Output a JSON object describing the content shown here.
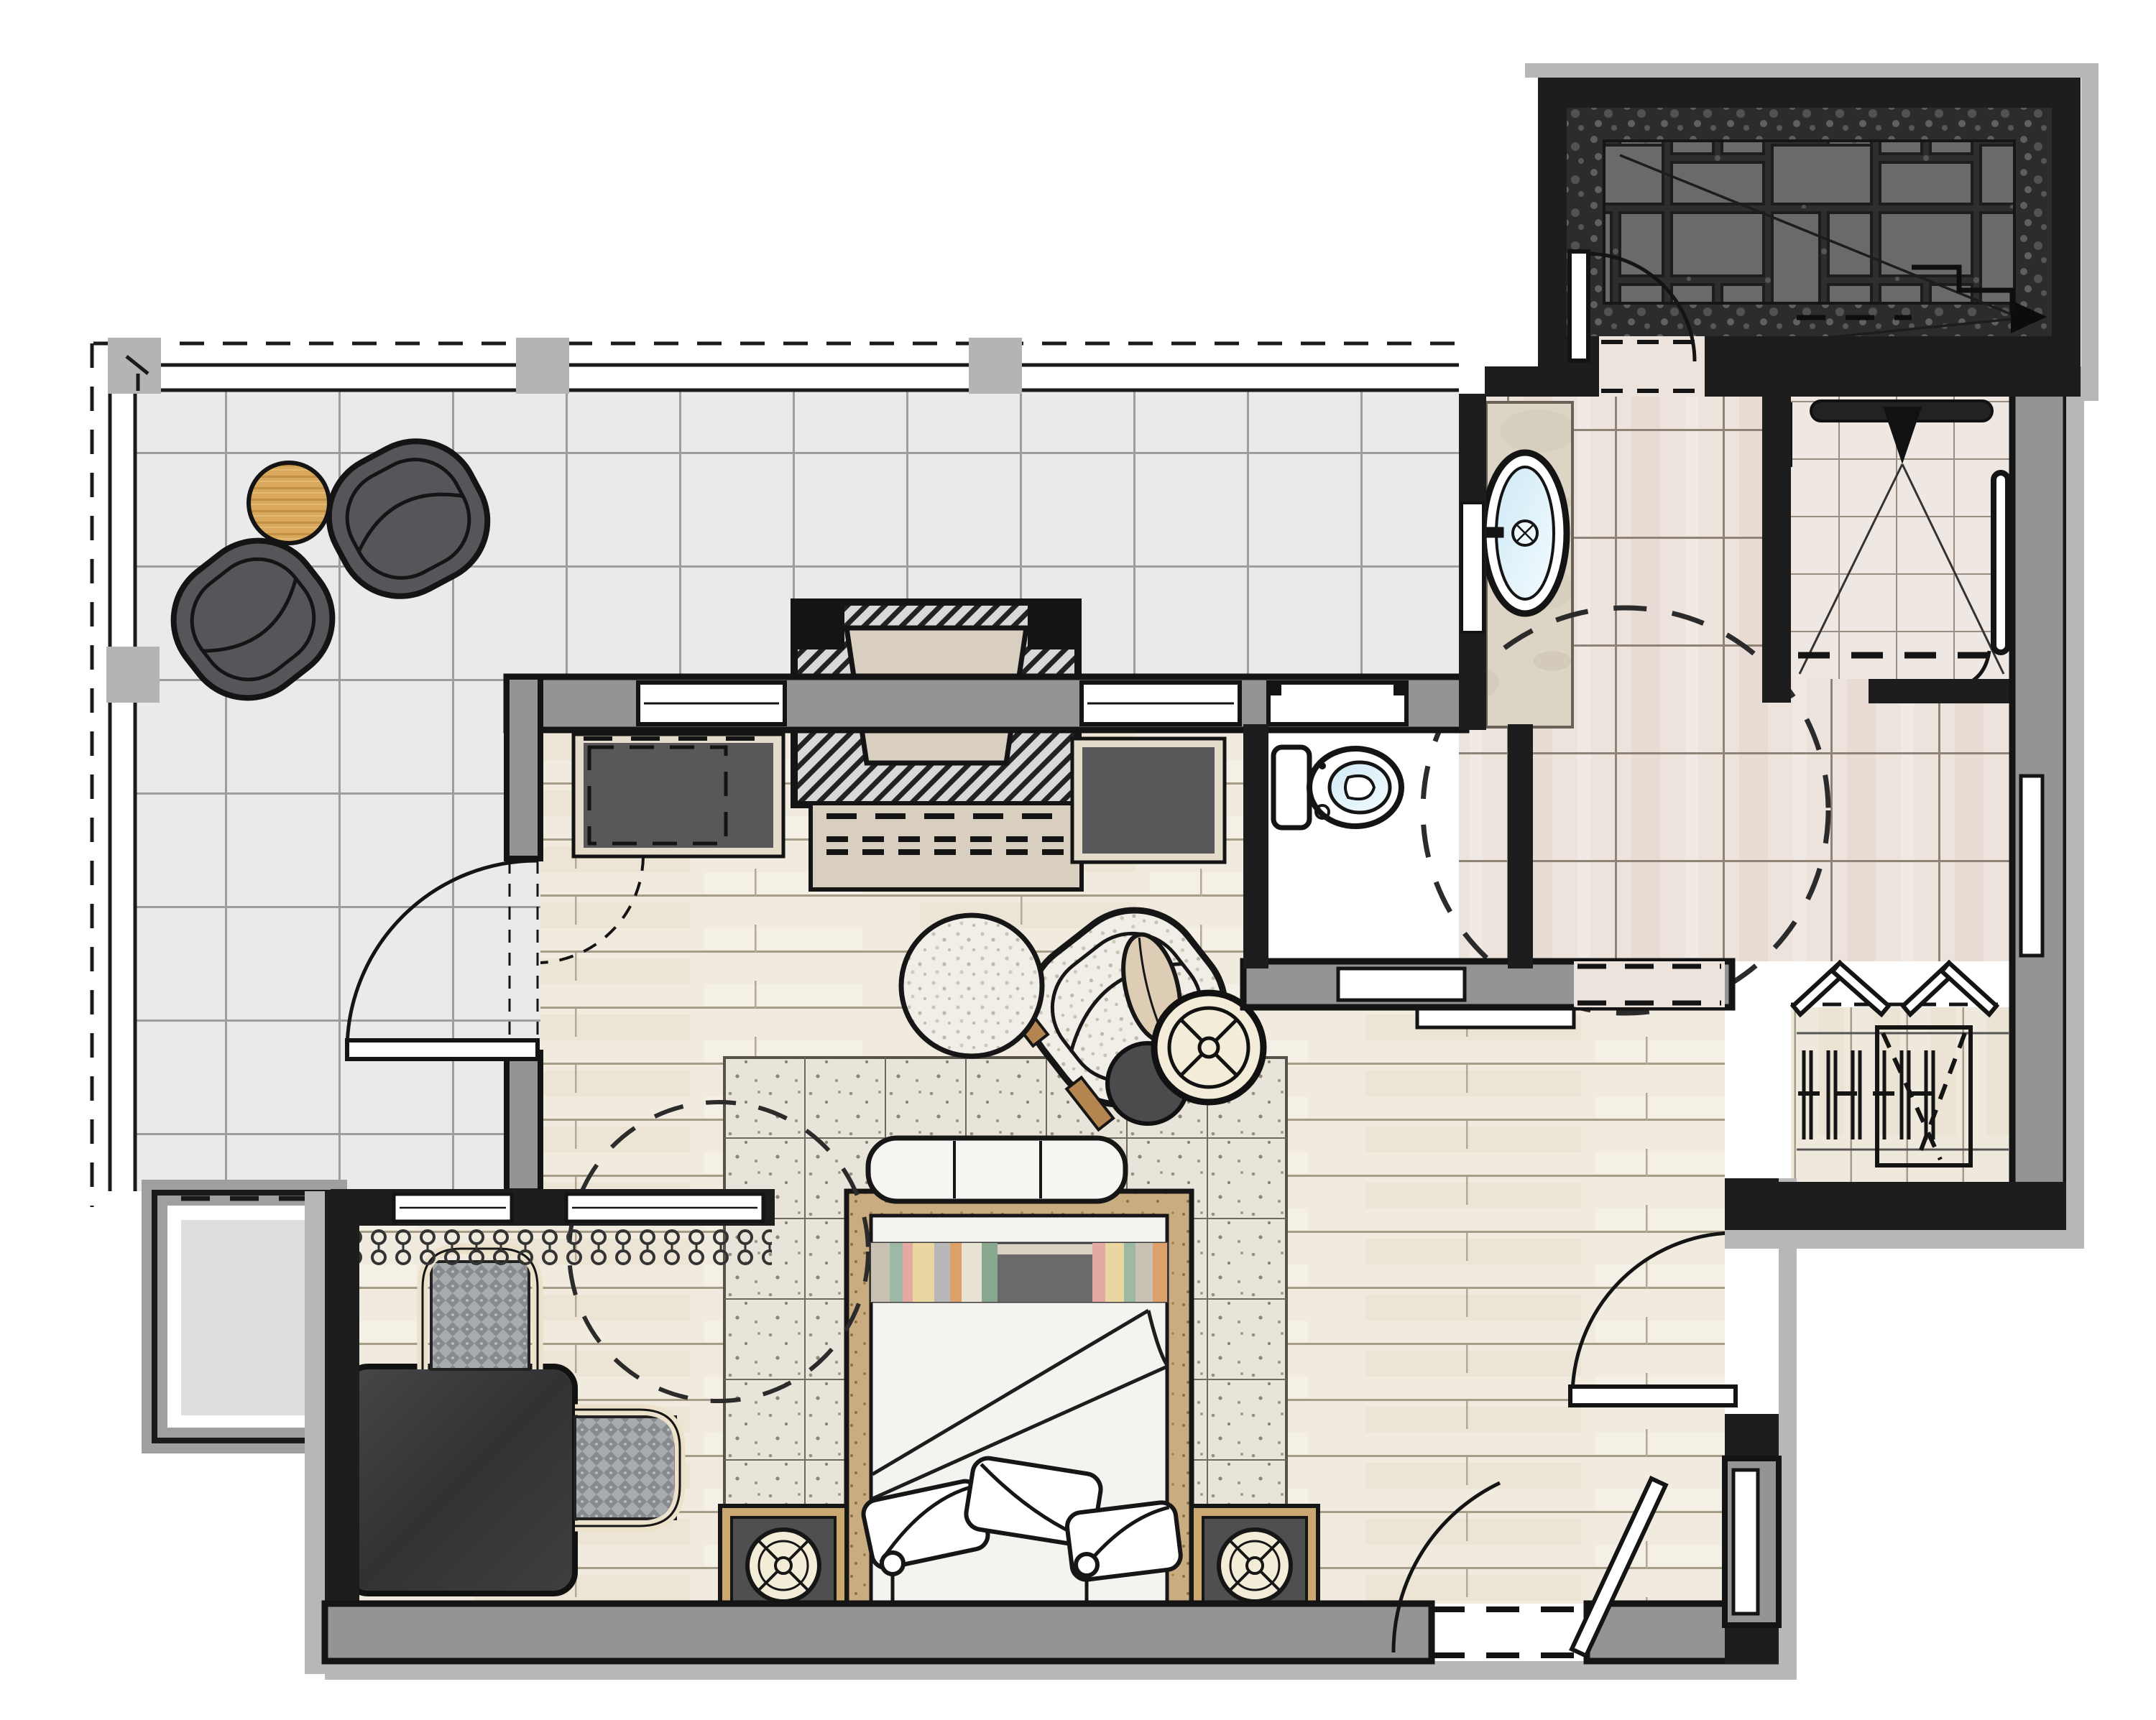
{
  "document": {
    "title": "Hotel suite interior floor plan rendering"
  },
  "colors": {
    "wall_black": "#1a1a1a",
    "wall_fill_gray": "#949494",
    "outer_gray": "#b7b7b7",
    "balcony_tile": "#eaeaec",
    "balcony_grout": "#9d9da0",
    "wood_floor": "#f1ebdf",
    "wood_line": "#a69d89",
    "bath_tile": "#ece3dc",
    "bath_grout": "#8f8276",
    "patio_dark": "#2e2e30",
    "patio_slab": "#6a6a6c",
    "marble_deck": "#dcd4c5",
    "tub_water": "#d6ecf7",
    "rug_base": "#e8e4d9",
    "bed_wood_frame": "#c9ad80",
    "round_table_wood": "#d8a95c",
    "dark_furniture": "#4b4b4d",
    "lounge_chair_gray": "#55565a",
    "boucle_cream": "#f0eee7",
    "desk_charcoal": "#39393b",
    "woven_seat_gray": "#a7abae",
    "cream_frame": "#ece2cb",
    "stripe_colors": [
      "#c9c2b4",
      "#e4a9a2",
      "#9db8a4",
      "#ead6a0",
      "#6a6a6a",
      "#dca06a",
      "#b8b8b8",
      "#88a890"
    ]
  },
  "rooms": {
    "balcony": {
      "label": "Tiled balcony terrace"
    },
    "patio": {
      "label": "Dark flagstone patio"
    },
    "bedroom": {
      "label": "Bedroom with whitewashed wood floor"
    },
    "alcove": {
      "label": "Desk alcove"
    },
    "bathroom": {
      "label": "Bathroom"
    },
    "wc": {
      "label": "Water closet"
    },
    "shower": {
      "label": "Walk-in shower room"
    },
    "closet": {
      "label": "Closet with hanging rod"
    },
    "niche": {
      "label": "Exterior storage niche"
    }
  },
  "furniture": {
    "bed": {
      "label": "Bed with striped blanket, folded duvet and three pillows"
    },
    "bench": {
      "label": "Upholstered bench at foot of bed"
    },
    "rug": {
      "label": "Speckled area rug"
    },
    "nightstand_left": {
      "label": "Left nightstand with round lamp"
    },
    "nightstand_right": {
      "label": "Right nightstand with round lamp"
    },
    "fireplace": {
      "label": "Fireplace with stone hearth"
    },
    "cabinet_left": {
      "label": "Built-in console left of fireplace"
    },
    "cabinet_right": {
      "label": "Built-in console right of fireplace"
    },
    "armchair": {
      "label": "Curved boucle lounge chair with pillow"
    },
    "pouf": {
      "label": "Round cream pouf"
    },
    "side_table_dark": {
      "label": "Dark round side table"
    },
    "tray_table": {
      "label": "Cream spoked tray table"
    },
    "desk": {
      "label": "Charcoal writing desk"
    },
    "desk_chair": {
      "label": "Woven desk chair"
    },
    "guest_chair": {
      "label": "Woven guest chair"
    },
    "lounge_chair_1": {
      "label": "Outdoor lounge chair"
    },
    "lounge_chair_2": {
      "label": "Outdoor lounge chair"
    },
    "balcony_table": {
      "label": "Round wooden balcony table"
    }
  },
  "fixtures": {
    "bathtub": {
      "label": "Freestanding oval bathtub on marble deck"
    },
    "tub_filler": {
      "label": "Wall-mounted tub filler"
    },
    "toilet": {
      "label": "Toilet"
    },
    "shower_head": {
      "label": "Rain shower bar with spray cone"
    },
    "grab_bar": {
      "label": "Shower grab bar"
    },
    "curtain_coil": {
      "label": "Shower curtain symbol"
    },
    "hangers": {
      "label": "Clothes hangers on rod"
    },
    "luggage_rack": {
      "label": "Luggage rack / hamper"
    }
  },
  "doors": {
    "entry_door": {
      "label": "Entry door swinging into suite"
    },
    "balcony_door": {
      "label": "Door to balcony"
    },
    "patio_door": {
      "label": "Door from bath hall to stone patio"
    },
    "connecting_door": {
      "label": "Connecting door in bottom wall"
    },
    "wc_pocket_door": {
      "label": "Pocket door to water closet"
    },
    "bifold_door": {
      "label": "Bifold closet doors"
    },
    "sliding_panel": {
      "label": "Sliding panel at bathroom opening"
    }
  },
  "annotations": {
    "turning_circle_bath": {
      "label": "Dashed accessibility turning circle in bathroom"
    },
    "turning_circle_bedroom": {
      "label": "Dashed accessibility turning circle in bedroom"
    },
    "slope_arrow": {
      "label": "Patio drainage slope arrow"
    },
    "curtain": {
      "label": "Drapery tassels below alcove windows"
    },
    "railing": {
      "label": "Balcony railing with posts"
    }
  }
}
